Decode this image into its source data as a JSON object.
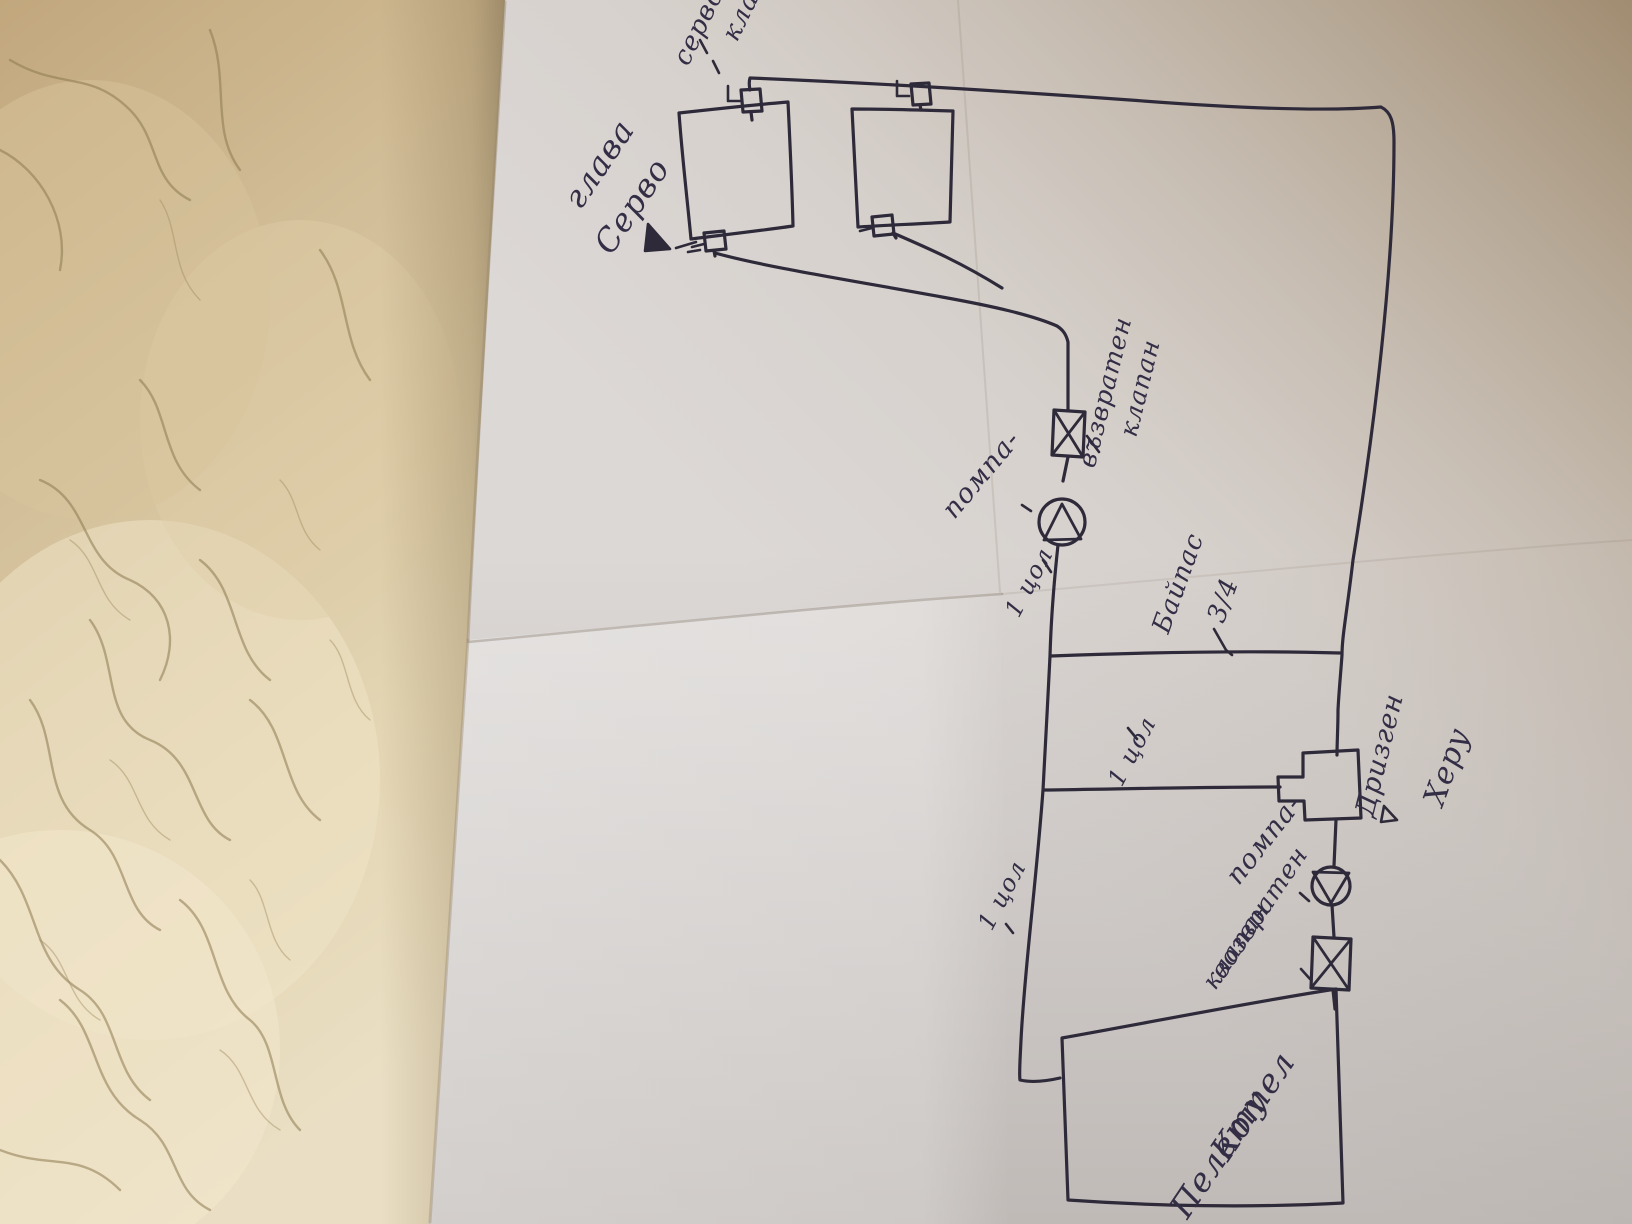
{
  "photo": {
    "kind": "photograph of a hand-drawn heating/plumbing schematic on folded paper, rotated 90 degrees, lying on a beige leather surface"
  },
  "colors": {
    "ink": "#2e2a3a",
    "pen_text": "#332e46",
    "paper_base": "#dcd8d6",
    "paper_shadow_tan": "#a89878",
    "paper_bottom_shade": "#c9c2be",
    "leather_light": "#e9dcc0",
    "leather_mid": "#d5c29c",
    "leather_dark": "#b9995f",
    "vein": "#8d7a50"
  },
  "labels": {
    "cut_top_l1": "серво",
    "cut_top_l2": "кла",
    "servo_head_l1": "Серво",
    "servo_head_l2": "глава",
    "check1_l1": "възвратен",
    "check1_l2": "клапан",
    "pump1": "помпа-",
    "size1": "1 цол",
    "bypass_l1": "Байпас",
    "bypass_l2": "3/4",
    "size2": "1 цол",
    "tee_l1": "Дризген",
    "tee_l2": "Херу",
    "pump2": "помпа-",
    "check2_l1": "возвратен",
    "check2_l2": "клапан",
    "size3": "1 цол",
    "boiler_l1": "Котел",
    "boiler_l2": "Пелету"
  },
  "symbols": {
    "radiators": 2,
    "thermostatic_valves": "small square valves with L-handles on each radiator corner",
    "pumps": "circle with triangle, 2x",
    "check_valves": "rectangle with X, 2x",
    "tee_fitting": "T-shaped fitting near boiler return",
    "boiler": "large rectangle bottom right"
  }
}
